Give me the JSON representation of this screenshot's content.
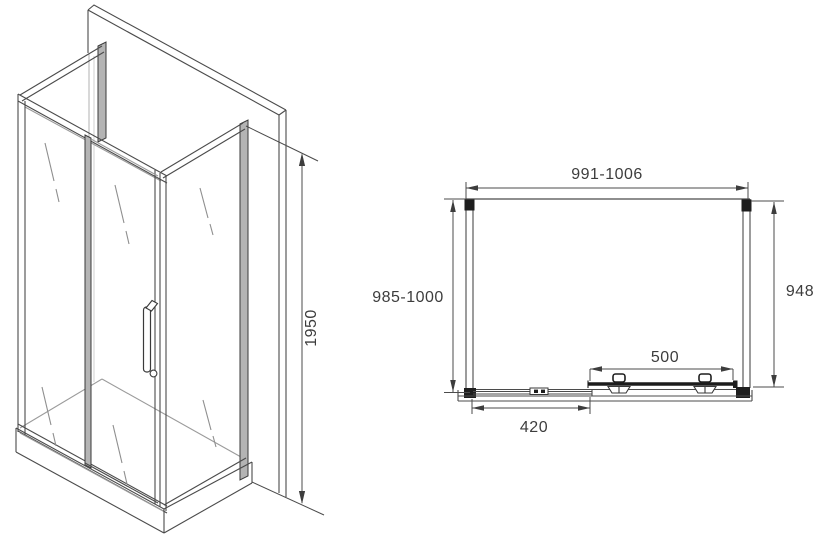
{
  "drawing": {
    "background_color": "#ffffff",
    "line_color": "#4b4b4b",
    "light_line_color": "#9b9b9b",
    "dark_fill_color": "#1e1e1e",
    "profile_fill_color": "#b4b4b4",
    "isometric_view": {
      "dimensions": {
        "height": "1950"
      }
    },
    "plan_view": {
      "dimensions": {
        "front_width_range": "991-1006",
        "left_depth_range": "985-1000",
        "inner_depth": "948",
        "sliding_door_width": "500",
        "fixed_panel_width": "420"
      }
    }
  }
}
